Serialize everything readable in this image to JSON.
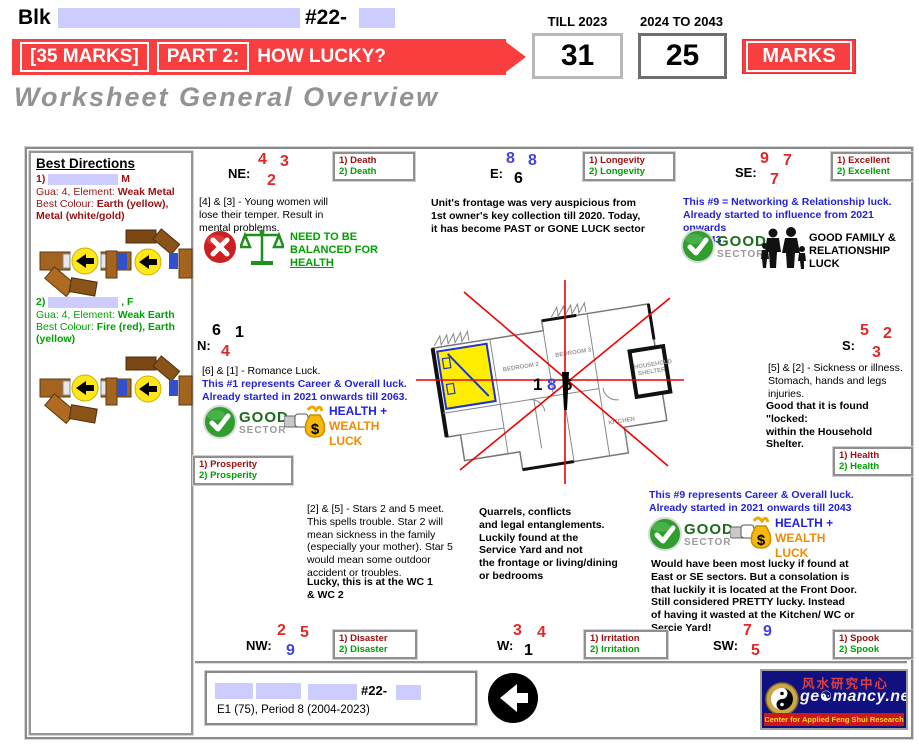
{
  "palette": {
    "banner_red": "#f83e3e",
    "star_red": "#e02828",
    "star_blue": "#4343d6",
    "dark_red_text": "#991111",
    "green_text": "#00a000",
    "blue_text": "#2323d9",
    "orange_text": "#f08a00",
    "redaction": "#ccccff",
    "logo_navy": "#101080"
  },
  "header": {
    "blk_label": "Blk",
    "unit_prefix": "#22-",
    "marks_badge": "[35 MARKS]",
    "part_label": "PART 2:",
    "question": "HOW LUCKY?",
    "subtitle": "Worksheet General Overview",
    "till_label": "TILL 2023",
    "till_value": "31",
    "next_label": "2024 TO 2043",
    "next_value": "25",
    "marks_button": "MARKS"
  },
  "best_directions": {
    "title": "Best Directions",
    "p1": {
      "num": "1)",
      "gender": "M",
      "gua_label": "Gua: 4, Element: ",
      "gua_value": "Weak Metal",
      "col_label": "Best Colour: ",
      "col_value": "Earth (yellow), Metal (white/gold)"
    },
    "p2": {
      "num": "2)",
      "gender": ", F",
      "gua_label": "Gua: 4, Element: ",
      "gua_value": "Weak Earth",
      "col_label": "Best Colour: ",
      "col_value": "Fire (red), Earth (yellow)"
    }
  },
  "sectors": {
    "ne": {
      "label": "NE:",
      "s1": "4",
      "s2": "3",
      "s3": "2",
      "tag1": "1) Death",
      "tag2": "2) Death",
      "desc": "[4] & [3] - Young women will lose their temper. Result in mental problems.",
      "balance_pre": "NEED TO BE BALANCED FOR ",
      "balance_word": "HEALTH"
    },
    "e": {
      "label": "E:",
      "s1": "8",
      "s2": "8",
      "s3": "6",
      "tag1": "1) Longevity",
      "tag2": "2) Longevity",
      "desc": "Unit's frontage was very auspicious from 1st owner's key collection till 2020. Today, it has become PAST or GONE LUCK sector"
    },
    "se": {
      "label": "SE:",
      "s1": "9",
      "s2": "7",
      "s3": "7",
      "tag1": "1) Excellent",
      "tag2": "2) Excellent",
      "blue": "This #9 = Networking & Relationship luck.\nAlready started to influence from 2021 onwards\ntill 2043",
      "good": "GOOD",
      "sector": "SECTOR",
      "family": "GOOD FAMILY & RELATIONSHIP LUCK"
    },
    "n": {
      "label": "N:",
      "s1": "6",
      "s2": "1",
      "s3": "4",
      "tag1": "1) Prosperity",
      "tag2": "2) Prosperity",
      "desc": "[6] & [1] - Romance Luck.",
      "blue": "This #1 represents Career & Overall luck.\nAlready started in 2021 onwards till 2063.",
      "good": "GOOD",
      "sector": "SECTOR",
      "health": "HEALTH +",
      "wealth": "WEALTH",
      "luck": "LUCK"
    },
    "s": {
      "label": "S:",
      "s1": "5",
      "s2": "2",
      "s3": "3",
      "tag1": "1) Health",
      "tag2": "2) Health",
      "desc": "[5] & [2] - Sickness or illness.\nStomach, hands and legs\ninjuries.",
      "bold": "Good that it is found \"locked:\nwithin the Household Shelter."
    },
    "nw": {
      "label": "NW:",
      "s1": "2",
      "s2": "5",
      "s3": "9",
      "tag1": "1) Disaster",
      "tag2": "2) Disaster"
    },
    "w": {
      "label": "W:",
      "s1": "3",
      "s2": "4",
      "s3": "1",
      "tag1": "1) Irritation",
      "tag2": "2) Irritation"
    },
    "sw": {
      "label": "SW:",
      "s1": "7",
      "s2": "9",
      "s3": "5",
      "tag1": "1) Spook",
      "tag2": "2) Spook"
    }
  },
  "notes": {
    "stars25": "[2] & [5] - Stars 2 and 5 meet.\nThis spells trouble. Star 2 will\nmean sickness in the family\n(especially your mother). Star 5\nwould mean some outdoor\naccident or troubles.",
    "stars25_bold": "Lucky, this is at the WC 1\n& WC 2",
    "quarrels": "Quarrels, conflicts\nand legal entanglements.\nLuckily found at the\nService Yard and not\nthe frontage or living/dining\nor bedrooms",
    "n9_blue": "This #9 represents Career & Overall luck.\nAlready started in 2021 onwards till 2043",
    "n9_good": "GOOD",
    "n9_sector": "SECTOR",
    "n9_health": "HEALTH +",
    "n9_wealth": "WEALTH",
    "n9_luck": "LUCK",
    "n9_bold": "Would have been most lucky if found at\nEast or SE sectors. But a consolation is\nthat luckily it is located at the Front Door.\nStill considered PRETTY lucky. Instead\nof having it wasted at the Kitchen/ WC or\nSercie Yard!"
  },
  "floor_plan": {
    "c1": "1",
    "c2": "8",
    "c3": "6",
    "labels": {
      "bedroom2": "BEDROOM 2",
      "bedroom3": "BEDROOM 3",
      "kitchen": "KITCHEN",
      "shelter1": "HOUSEHOLD",
      "shelter2": "SHELTER"
    }
  },
  "footer": {
    "unit": "#22-",
    "period": "E1 (75), Period 8 (2004-2023)"
  },
  "logo": {
    "chinese": "风水研究中心",
    "site_pre": "ge",
    "site_yin": "☯",
    "site_post": "mancy.net",
    "tagline": "Center for Applied Feng Shui Research"
  }
}
